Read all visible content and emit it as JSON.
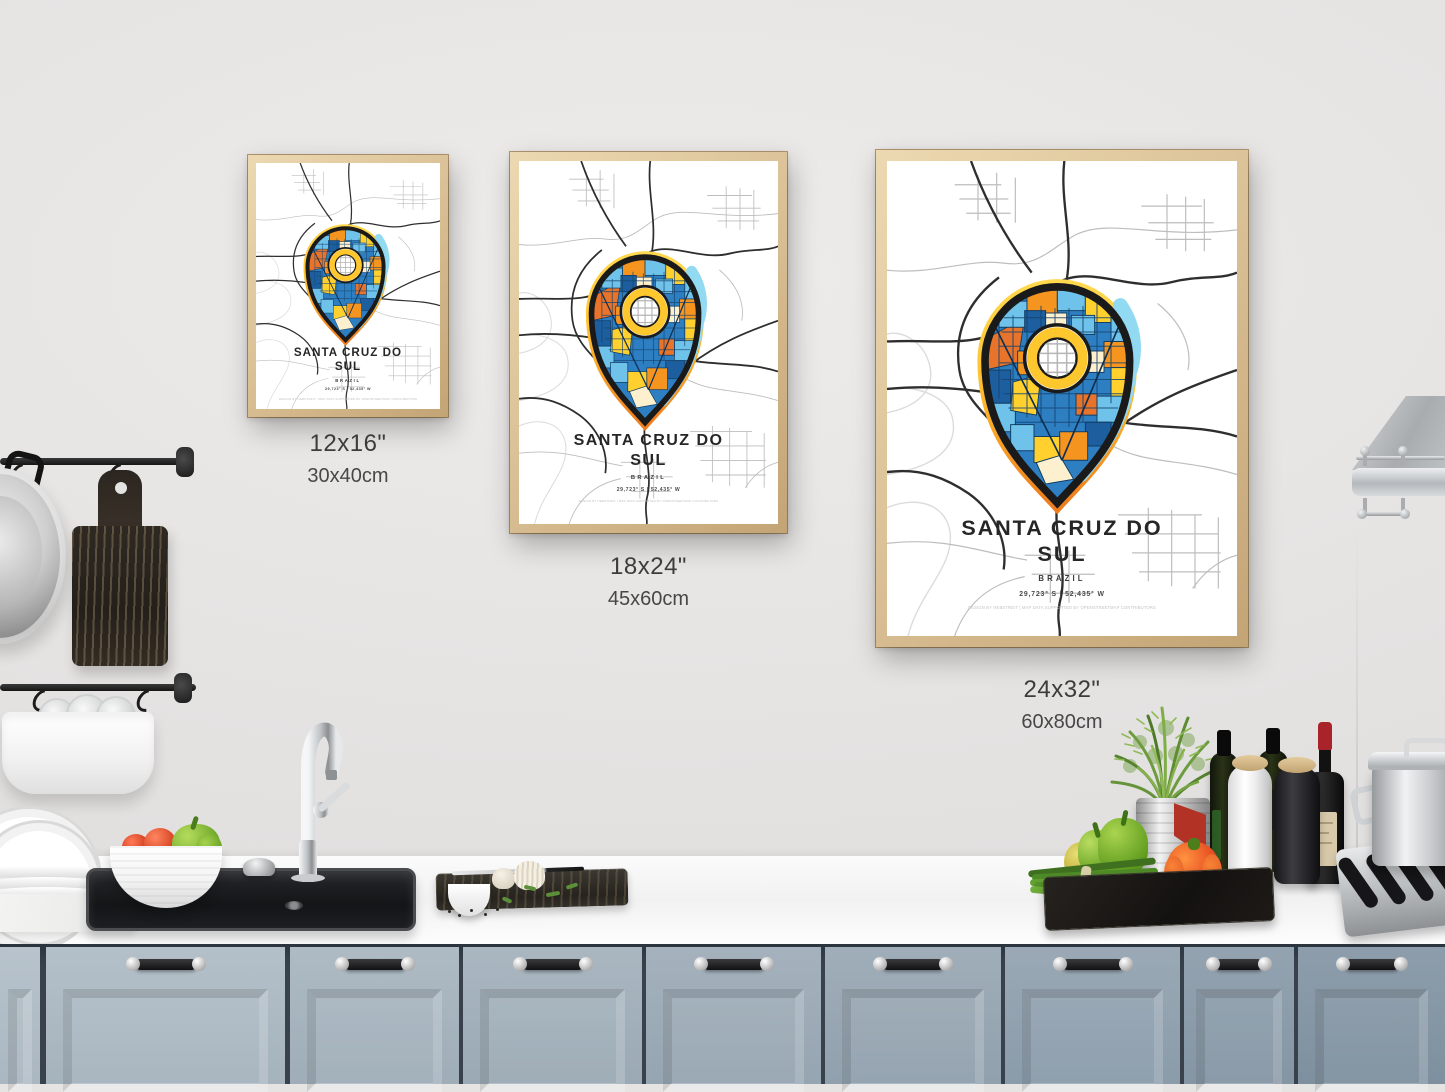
{
  "poster": {
    "title_line1": "SANTA CRUZ DO",
    "title_line2": "SUL",
    "country": "BRAZIL",
    "coordinates": "29,723° S | 52,435° W",
    "credit": "DESIGN BY HEBSTREIT | MAP DATA SUPPORTED BY OPENSTREETMAP CONTRIBUTORS",
    "subject": "Santa Cruz do Sul street map with mosaic location pin",
    "colors": {
      "frame_wood": "#d8bd92",
      "pin_yellow": "#ffc72e",
      "pin_orange": "#ee7d1e",
      "pin_light_blue": "#92d9f2",
      "map_blue": "#2e7fc2",
      "map_orange": "#f5941e"
    }
  },
  "size_labels": [
    {
      "inches": "12x16\"",
      "cm": "30x40cm"
    },
    {
      "inches": "18x24\"",
      "cm": "45x60cm"
    },
    {
      "inches": "24x32\"",
      "cm": "60x80cm"
    }
  ],
  "kitchen": {
    "cabinet_color": "#9fafba",
    "counter_color": "#f4f4f5",
    "wall_color": "#e6e4e3"
  }
}
